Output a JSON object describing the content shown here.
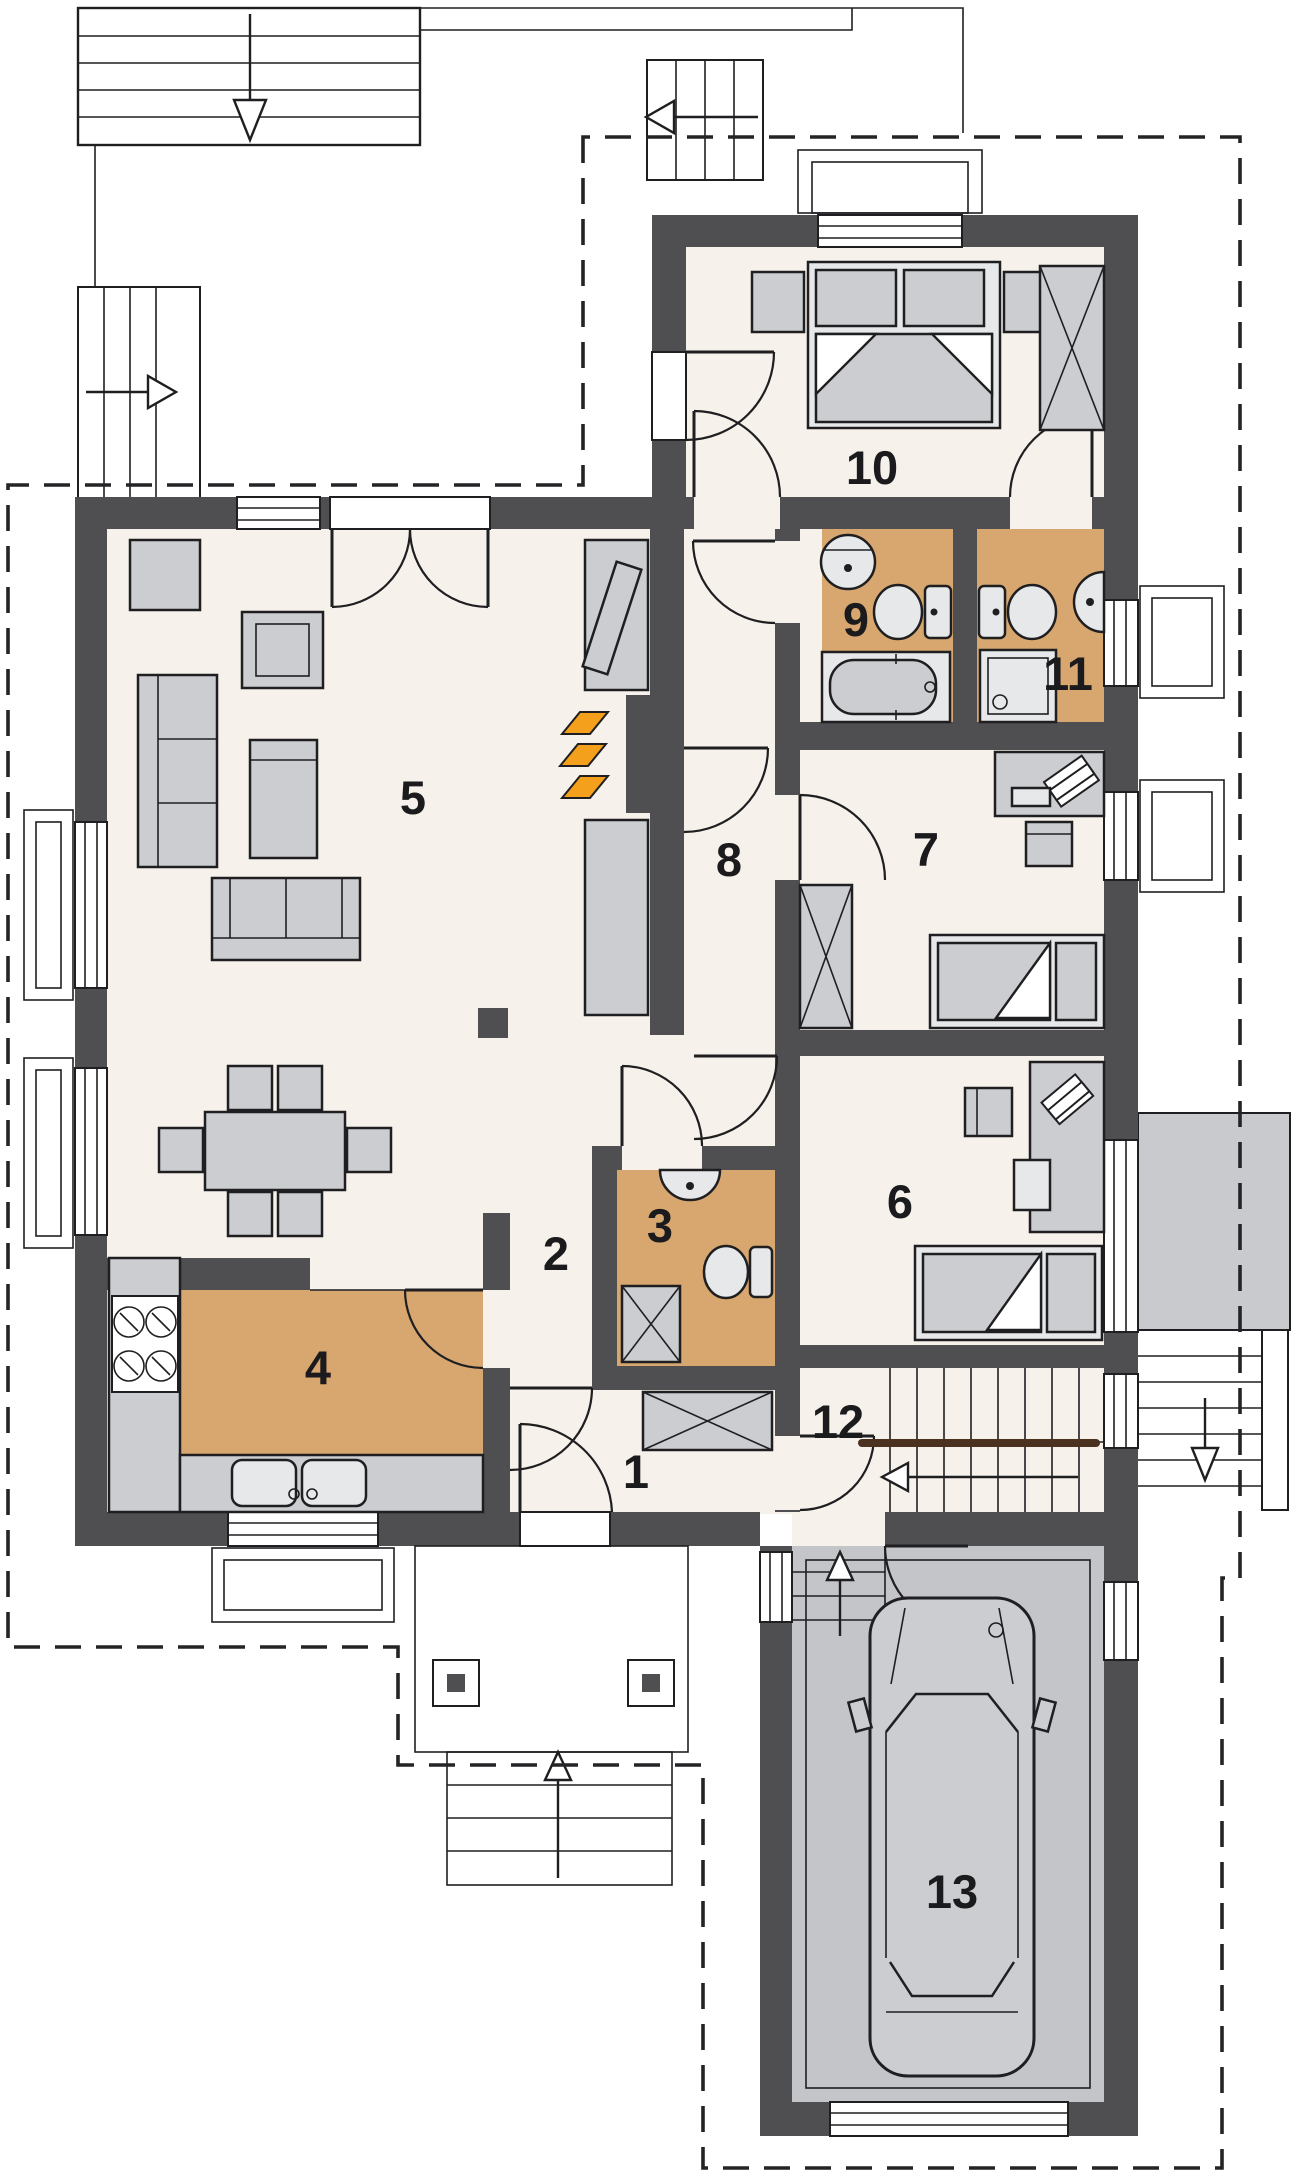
{
  "plan": {
    "kind": "house-floor-plan",
    "room_count": 13
  },
  "rooms": {
    "r1": {
      "number": "1"
    },
    "r2": {
      "number": "2"
    },
    "r3": {
      "number": "3"
    },
    "r4": {
      "number": "4"
    },
    "r5": {
      "number": "5"
    },
    "r6": {
      "number": "6"
    },
    "r7": {
      "number": "7"
    },
    "r8": {
      "number": "8"
    },
    "r9": {
      "number": "9"
    },
    "r10": {
      "number": "10"
    },
    "r11": {
      "number": "11"
    },
    "r12": {
      "number": "12"
    },
    "r13": {
      "number": "13"
    }
  },
  "colors": {
    "wall": "#4f4f51",
    "floor": "#f6f1ea",
    "accentFloor": "#d7a76f",
    "furniture": "#cccdd0",
    "furnitureLight": "#e7e8ea",
    "garageFloor": "#c4c5c8",
    "terrace": "#c9cacd",
    "line": "#1f1f22",
    "flame": "#f5a01d",
    "handrail": "#4a3120",
    "dash": "#242427"
  }
}
